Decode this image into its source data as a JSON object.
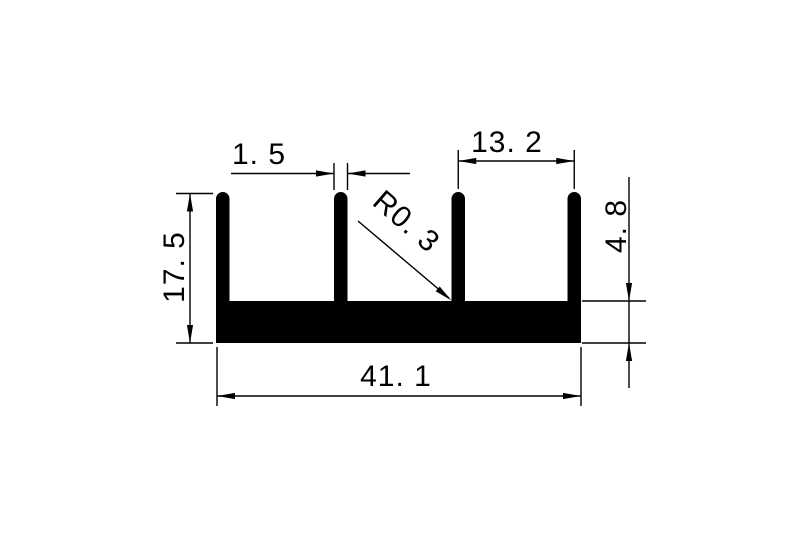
{
  "drawing": {
    "kind": "technical-dimension-drawing",
    "colors": {
      "background": "#ffffff",
      "ink": "#000000"
    },
    "profile": {
      "fin_count": 4
    },
    "dimensions": {
      "fin_thickness": {
        "label": "1. 5",
        "value": 1.5
      },
      "fin_pitch": {
        "label": "13. 2",
        "value": 13.2
      },
      "fillet_radius": {
        "label": "R0. 3",
        "value": 0.3
      },
      "overall_height": {
        "label": "17. 5",
        "value": 17.5
      },
      "base_thickness": {
        "label": "4. 8",
        "value": 4.8
      },
      "overall_width": {
        "label": "41. 1",
        "value": 41.1
      }
    }
  }
}
